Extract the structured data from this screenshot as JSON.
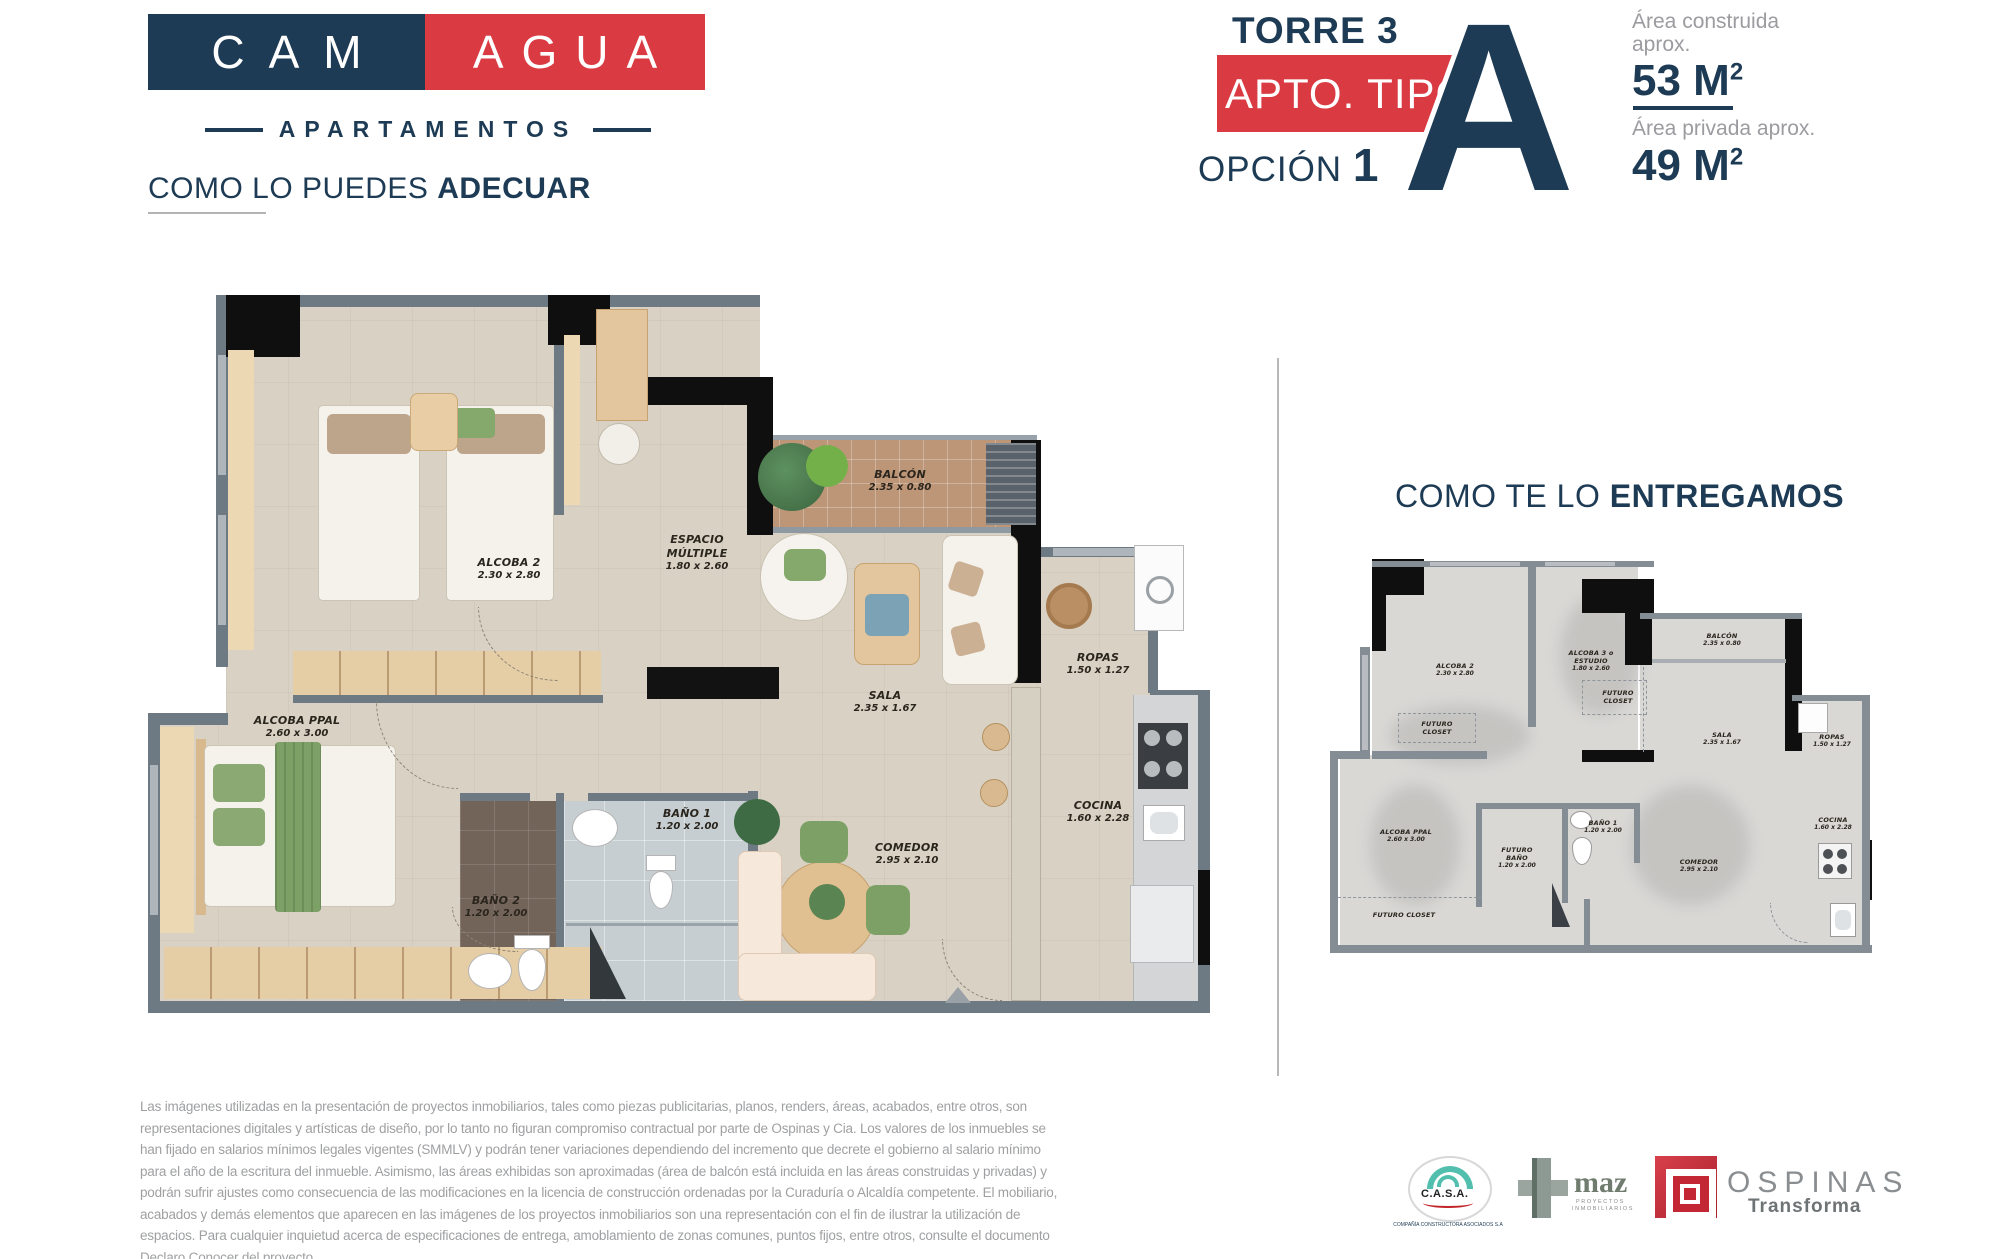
{
  "colors": {
    "navy": "#1d3b54",
    "red": "#da3a42",
    "gray_text": "#9fa0a2",
    "plan_floor": "#d9d2c4",
    "balcony_tan": "#bd9577",
    "wall_gray": "#6d7983",
    "wall_black": "#0f0f10",
    "plan2_floor": "#d9d8d5",
    "plan2_wall": "#858d94",
    "accent_green": "#7ca065",
    "teal": "#52bfae"
  },
  "brand": {
    "logo_part1": "CAM",
    "logo_part2": "AGUA",
    "subtitle": "APARTAMENTOS"
  },
  "unit_header": {
    "tower": "TORRE 3",
    "apt_type_label": "APTO. TIPO",
    "option_label": "OPCIÓN",
    "option_number": "1",
    "type_letter": "A",
    "built_area_label_line1": "Área construida",
    "built_area_label_line2": "aprox.",
    "built_area_value": "53 M",
    "built_area_sup": "2",
    "private_area_label": "Área privada aprox.",
    "private_area_value": "49 M",
    "private_area_sup": "2"
  },
  "section_left": {
    "title_regular": "COMO LO PUEDES",
    "title_bold": "ADECUAR"
  },
  "section_right": {
    "title_regular": "COMO TE LO",
    "title_bold": "ENTREGAMOS"
  },
  "plan_adecuar": {
    "rooms": [
      {
        "name": "ALCOBA 2",
        "dims": "2.30 x 2.80"
      },
      {
        "name": "ESPACIO MÚLTIPLE",
        "dims": "1.80 x 2.60"
      },
      {
        "name": "BALCÓN",
        "dims": "2.35 x 0.80"
      },
      {
        "name": "SALA",
        "dims": "2.35 x 1.67"
      },
      {
        "name": "ROPAS",
        "dims": "1.50 x 1.27"
      },
      {
        "name": "COCINA",
        "dims": "1.60 x 2.28"
      },
      {
        "name": "COMEDOR",
        "dims": "2.95 x 2.10"
      },
      {
        "name": "BAÑO 1",
        "dims": "1.20 x 2.00"
      },
      {
        "name": "BAÑO 2",
        "dims": "1.20 x 2.00"
      },
      {
        "name": "ALCOBA PPAL",
        "dims": "2.60 x 3.00"
      }
    ]
  },
  "plan_entrega": {
    "rooms": [
      {
        "name": "ALCOBA 2",
        "dims": "2.30 x 2.80"
      },
      {
        "name": "ALCOBA 3 o ESTUDIO",
        "dims": "1.80 x 2.60"
      },
      {
        "name": "FUTURO CLOSET",
        "dims": ""
      },
      {
        "name": "FUTURO CLOSET",
        "dims": ""
      },
      {
        "name": "BALCÓN",
        "dims": "2.35 x 0.80"
      },
      {
        "name": "SALA",
        "dims": "2.35 x 1.67"
      },
      {
        "name": "ROPAS",
        "dims": "1.50 x 1.27"
      },
      {
        "name": "COCINA",
        "dims": "1.60 x 2.28"
      },
      {
        "name": "ALCOBA PPAL",
        "dims": "2.60 x 3.00"
      },
      {
        "name": "FUTURO BAÑO",
        "dims": "1.20 x 2.00"
      },
      {
        "name": "BAÑO 1",
        "dims": "1.20 x 2.00"
      },
      {
        "name": "FUTURO CLOSET",
        "dims": ""
      },
      {
        "name": "COMEDOR",
        "dims": "2.95 x 2.10"
      }
    ]
  },
  "disclaimer": {
    "text": "Las imágenes utilizadas en la presentación de proyectos inmobiliarios, tales como piezas publicitarias, planos, renders, áreas, acabados, entre otros, son representaciones digitales y artísticas de diseño, por lo tanto no figuran compromiso contractual por parte de Ospinas y Cia. Los valores de los inmuebles se han fijado en salarios mínimos legales vigentes (SMMLV) y podrán tener variaciones dependiendo del incremento que decrete el gobierno al salario mínimo para el año de la escritura del inmueble. Asimismo, las áreas exhibidas son aproximadas (área de balcón está incluida en las áreas construidas y privadas) y podrán sufrir ajustes como consecuencia de las modificaciones en la licencia de construcción ordenadas por la Curaduría o Alcaldía competente. El mobiliario, acabados y demás elementos que aparecen en las imágenes de los proyectos inmobiliarios son una representación con el fin de ilustrar la utilización de espacios. Para cualquier inquietud acerca de especificaciones de entrega, amoblamiento de zonas comunes, puntos fijos, entre otros, consulte el documento Declaro Conocer del proyecto."
  },
  "footer_logos": {
    "casa": {
      "name": "C.A.S.A.",
      "tagline": "COMPAÑÍA CONSTRUCTORA ASOCIADOS S.A"
    },
    "maz": {
      "name": "maz",
      "tagline_line1": "PROYECTOS",
      "tagline_line2": "INMOBILIARIOS"
    },
    "ospinas": {
      "name": "OSPINAS",
      "tagline": "Transforma"
    }
  }
}
